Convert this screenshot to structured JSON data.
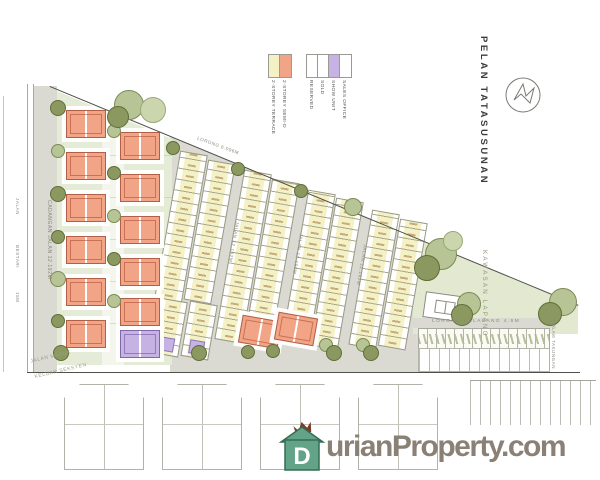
{
  "title": "PELAN TATASUSUNAN",
  "legend": {
    "unit_types": [
      {
        "label": "2-STOREY TERRACE",
        "color": "#f5f1c6"
      },
      {
        "label": "2-STOREY SEMI-D",
        "color": "#f1a486"
      }
    ],
    "statuses": [
      {
        "label": "RESERVED",
        "color": "#ffffff"
      },
      {
        "label": "SOLD",
        "color": "#ffffff"
      },
      {
        "label": "SHOW UNIT",
        "color": "#c6b3e4"
      },
      {
        "label": "SALES OFFICE",
        "color": "#ffffff"
      }
    ]
  },
  "roads": {
    "main_road": "CADANGAN JALAN 12.192M",
    "internal_road_1": "JALAN 12.192M",
    "internal_road_2": "JALAN 12.192M",
    "internal_road_3": "JALAN 12.192M",
    "top_lane": "LORONG 6.096M",
    "back_lane": "LORONG BELAKANG 4.9M",
    "outer_road_labels": [
      "JALAN",
      "BESTARI",
      "15M"
    ],
    "entrance_label_1": "JALAN MASUK",
    "entrance_label_2": "KELUAR SEKSYEN"
  },
  "areas": {
    "open_space": "KAWASAN LAPANG",
    "pond": "KOLAM TAKUNGAN"
  },
  "watermark": {
    "logo_letter": "D",
    "text": "urianProperty.com"
  }
}
